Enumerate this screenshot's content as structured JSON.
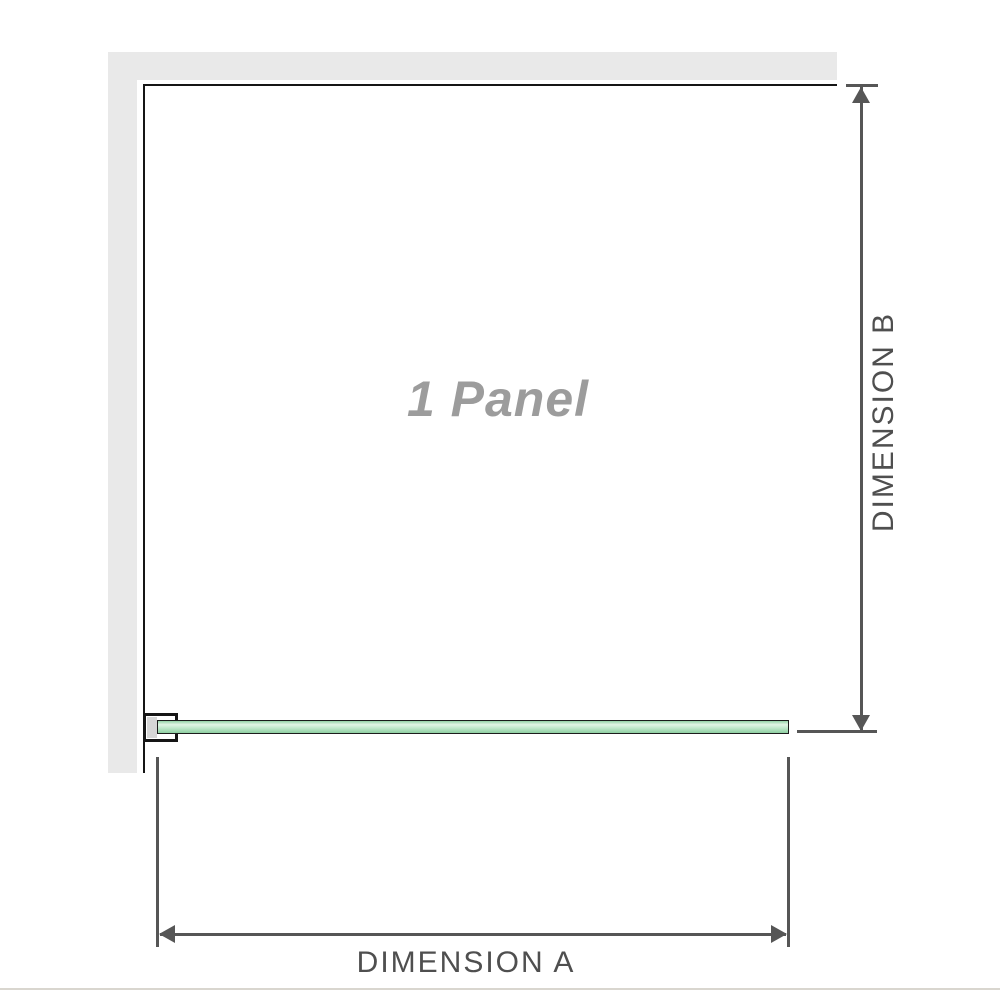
{
  "diagram": {
    "title": "1 Panel",
    "dimension_a": {
      "label": "DIMENSION A"
    },
    "dimension_b": {
      "label": "DIMENSION B"
    },
    "colors": {
      "wall": "#e9e9e9",
      "outline": "#151515",
      "dim": "#565656",
      "label": "#4f4f4f",
      "panel_label": "#9c9c9c",
      "bracket_fill": "#ffffff",
      "bracket_inner": "#d6d6d6",
      "glass_border": "#1c1c1c",
      "glass_1": "#94d2a6",
      "glass_2": "#e2f5e6",
      "glass_3": "#bce6c8",
      "glass_4": "#8ecfa1",
      "divider": "#d9d6cf",
      "bg": "#ffffff"
    },
    "icons": [
      "arrowhead-up-icon",
      "arrowhead-down-icon",
      "arrowhead-left-icon",
      "arrowhead-right-icon"
    ]
  }
}
